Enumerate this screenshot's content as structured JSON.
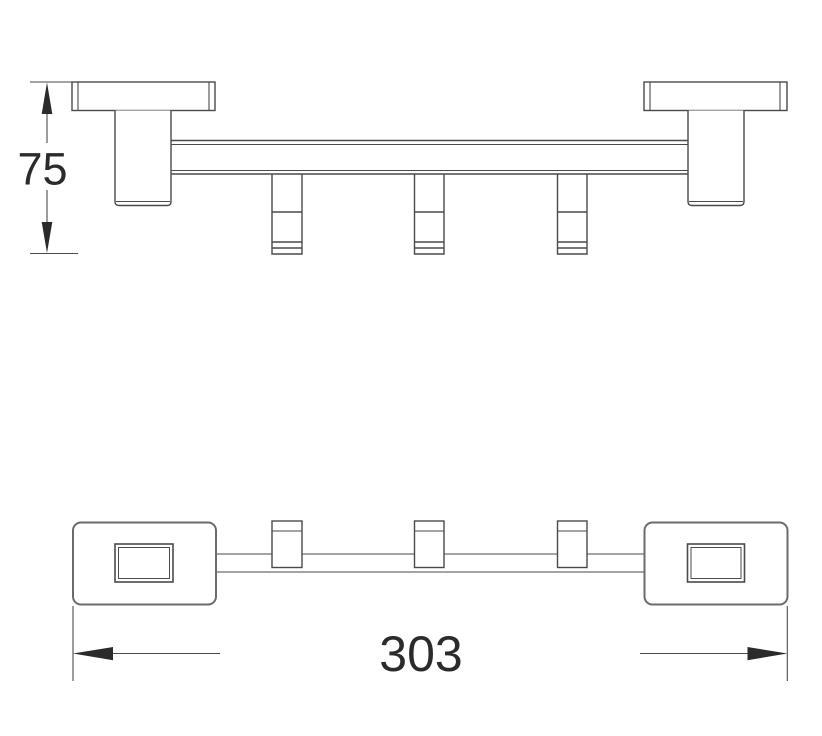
{
  "drawing": {
    "description": "Two-view technical drawing of a wall-mounted three-hook towel rail",
    "views": [
      {
        "id": "front-elevation",
        "dimension": {
          "label": "75",
          "axis": "vertical"
        }
      },
      {
        "id": "top-plan",
        "dimension": {
          "label": "303",
          "axis": "horizontal"
        }
      }
    ],
    "hook_count": 3,
    "colors": {
      "line": "#4a4a4a",
      "plate_line": "#6b6b6b",
      "arrow": "#2d2a2a",
      "text": "#2b2b2b",
      "background": "#ffffff"
    }
  }
}
